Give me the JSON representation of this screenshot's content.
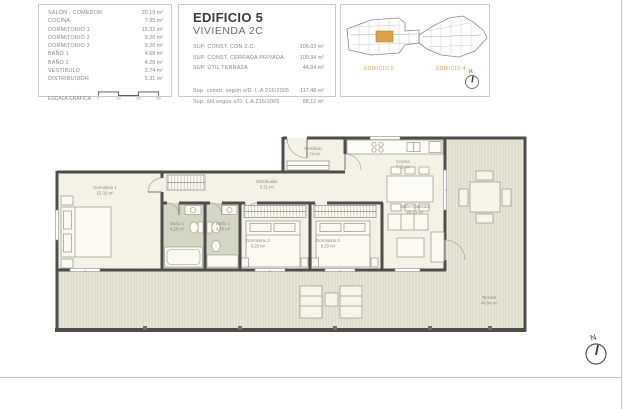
{
  "area_table": {
    "rows": [
      {
        "label": "SALÓN - COMEDOR",
        "value": "20.19 m²"
      },
      {
        "label": "COCINA",
        "value": "7.95 m²"
      },
      {
        "label": "DORMITORIO 1",
        "value": "15.32 m²"
      },
      {
        "label": "DORMITORIO 2",
        "value": "9.20 m²"
      },
      {
        "label": "DORMITORIO 3",
        "value": "9.20 m²"
      },
      {
        "label": "BAÑO 1",
        "value": "4.68 m²"
      },
      {
        "label": "BAÑO 2",
        "value": "4.28 m²"
      },
      {
        "label": "VESTÍBULO",
        "value": "2.74 m²"
      },
      {
        "label": "DISTRIBUIDOR",
        "value": "5.31 m²"
      }
    ],
    "scale_label": "ESCALA GRÁFICA",
    "scale_ticks": [
      "0",
      "1m",
      "2m",
      "3m"
    ]
  },
  "title_block": {
    "title": "EDIFICIO 5",
    "subtitle": "VIVIENDA 2C",
    "rows": [
      {
        "label": "SUP. CONST. CON Z.C.",
        "value": "106.03 m²"
      },
      {
        "label": "SUP. CONST. CERRADA PRIVADA",
        "value": "100.34 m²"
      },
      {
        "label": "SUP. ÚTIL TERRAZA",
        "value": "44.84 m²"
      }
    ],
    "legal_rows": [
      {
        "label": "Sup. constr. según s/D. L.A 216/2005",
        "value": "117.48 m²"
      },
      {
        "label": "Sup. útil según s/D. L.A 216/2005",
        "value": "88.12 m²"
      }
    ]
  },
  "key_plan": {
    "building_left_label": "EDIFICIO 5",
    "building_right_label": "EDIFICIO 4",
    "north_label": "N"
  },
  "floor_plan": {
    "rooms": [
      {
        "name": "Dormitorio 1",
        "area": "15.32 m²"
      },
      {
        "name": "Baño 2",
        "area": "4.28 m²"
      },
      {
        "name": "Baño 1",
        "area": "4.68 m²"
      },
      {
        "name": "Distribuidor",
        "area": "5.31 m²"
      },
      {
        "name": "Dormitorio 2",
        "area": "9.20 m²"
      },
      {
        "name": "Dormitorio 3",
        "area": "9.20 m²"
      },
      {
        "name": "Vestíbulo",
        "area": "2.74 m²"
      },
      {
        "name": "Cocina",
        "area": "7.95 m²"
      },
      {
        "name": "Salón-Comedor",
        "area": "20.19 m²"
      },
      {
        "name": "Terraza",
        "area": "44.84 m²"
      }
    ],
    "north_label": "N"
  },
  "colors": {
    "accent_orange": "#d9a14a",
    "wall": "#4d4d4d",
    "floor": "#f4f1e7",
    "bath_floor": "#d4d6c5",
    "terrace": "#e9e7d8"
  }
}
